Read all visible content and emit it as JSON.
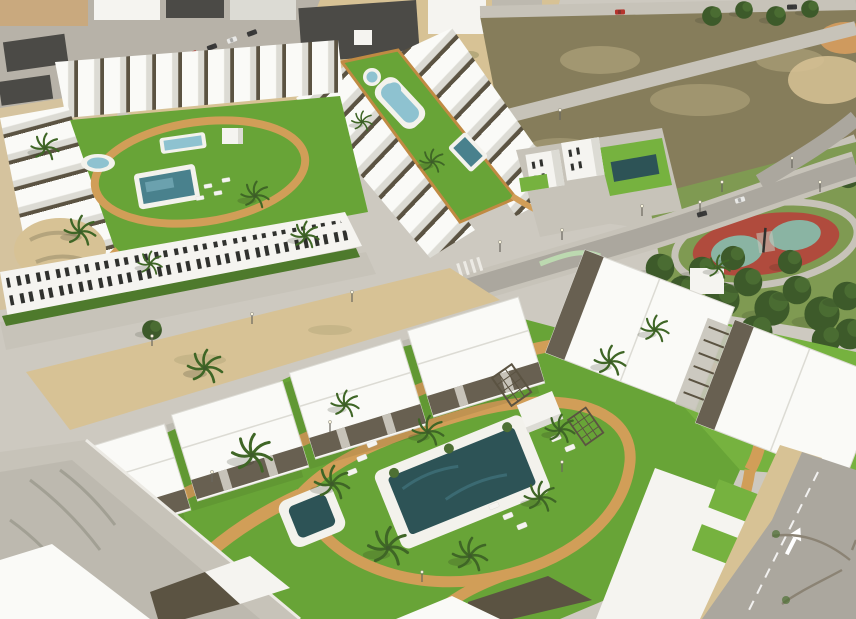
{
  "colors": {
    "base": "#cdc9c0",
    "sand": "#d7c295",
    "sand_deep": "#cf9a5e",
    "scrub": "#b5a87b",
    "town_road": "#b7b2a8",
    "town_dark_roof": "#4b4a46",
    "town_tan": "#c9a97e",
    "white": "#f5f4f0",
    "roof_white": "#fafaf7",
    "roof_shadow": "#dcdbd4",
    "pergola": "#5b5342",
    "window": "#30312e",
    "lawn": "#68a437",
    "lawn_bright": "#76b23f",
    "lawn_olive": "#7f9a52",
    "hedge": "#4e7a2c",
    "tree_dark": "#3d5a2a",
    "tree_mid": "#4e7034",
    "palm_green": "#3f6626",
    "path": "#d19e58",
    "path_deep": "#c08a43",
    "pool_dark": "#2d5356",
    "pool_mid": "#49818d",
    "pool_light": "#8ec2d0",
    "deck": "#f3f2ec",
    "road": "#aba79e",
    "road_light": "#c7c3b9",
    "concrete": "#bdb9af",
    "curb": "#eceae4",
    "dirt": "#867d5b",
    "dirt_light": "#b9ad84",
    "track_red": "#b04b3d",
    "track_teal": "#8ab4a3",
    "car_red": "#b5342c",
    "car_dark": "#3a3a3a",
    "car_white": "#e8e8e6",
    "shadow": "rgba(35,42,25,0.38)",
    "branch": "#8b8374",
    "lamp_warm": "#f7f2dc",
    "lamp_pole": "#6a685f",
    "lane_green": "#bcd9b0",
    "arrow": "#ffffff"
  }
}
